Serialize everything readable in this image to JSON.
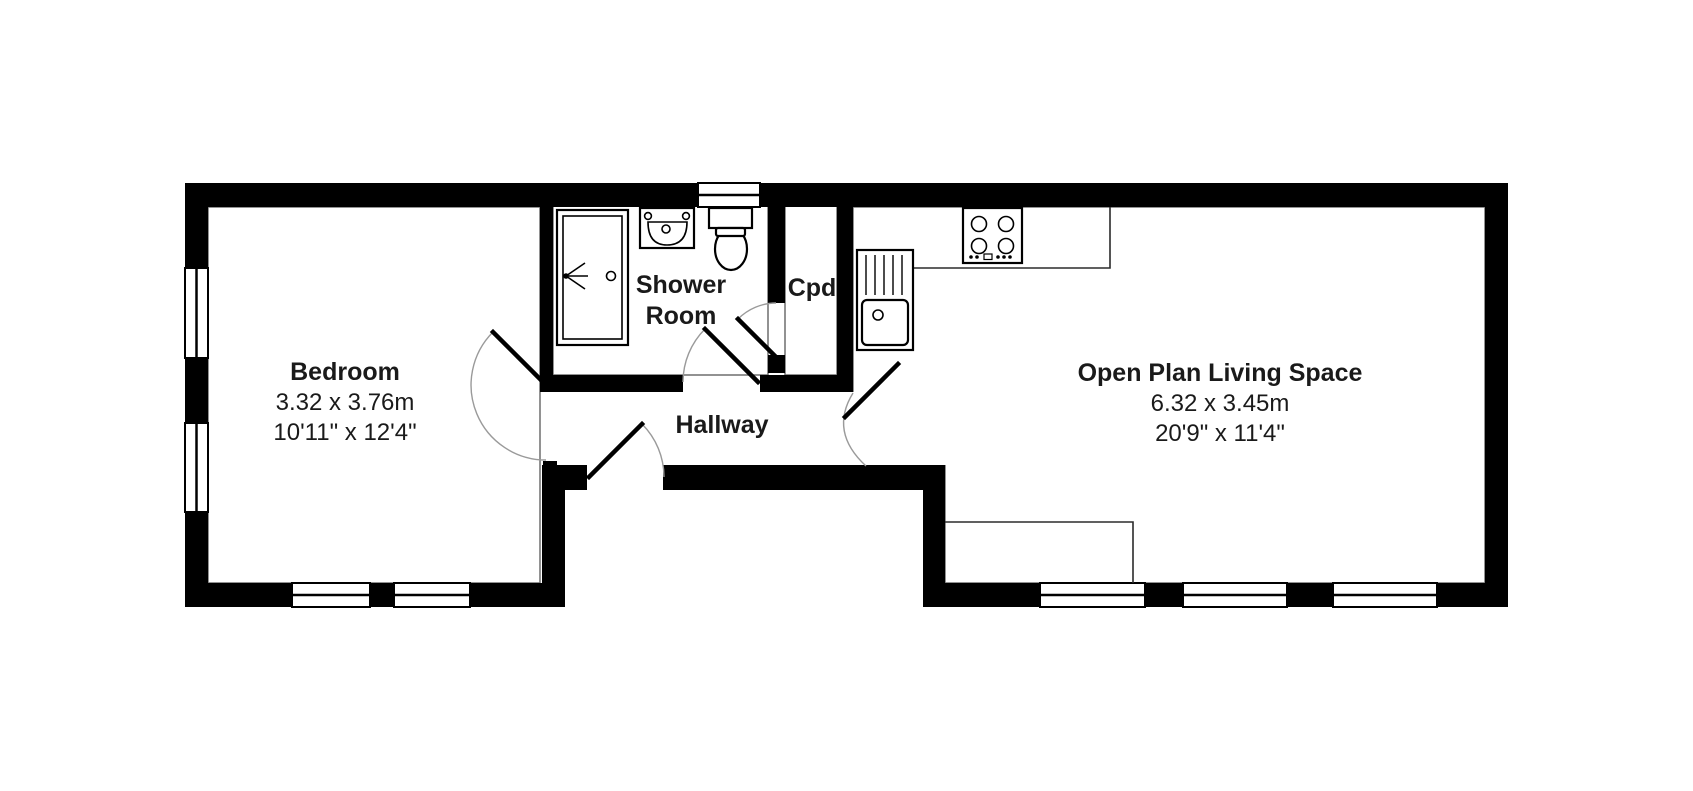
{
  "plan": {
    "background_color": "#ffffff",
    "wall_color": "#000000",
    "rooms": {
      "bedroom": {
        "name": "Bedroom",
        "dimensions_metric": "3.32 x 3.76m",
        "dimensions_imperial": "10'11\" x 12'4\""
      },
      "shower_room": {
        "lines": [
          "Shower",
          "Room"
        ]
      },
      "cupboard": {
        "name": "Cpd"
      },
      "hallway": {
        "name": "Hallway"
      },
      "open_plan": {
        "name": "Open Plan Living Space",
        "dimensions_metric": "6.32 x 3.45m",
        "dimensions_imperial": "20'9\" x 11'4\""
      }
    },
    "fixtures": [
      "shower-enclosure",
      "bathroom-sink",
      "toilet",
      "kitchen-sink-drainer",
      "hob",
      "kitchen-counter",
      "lounge-unit"
    ],
    "window_count": 8,
    "door_count": 5
  }
}
